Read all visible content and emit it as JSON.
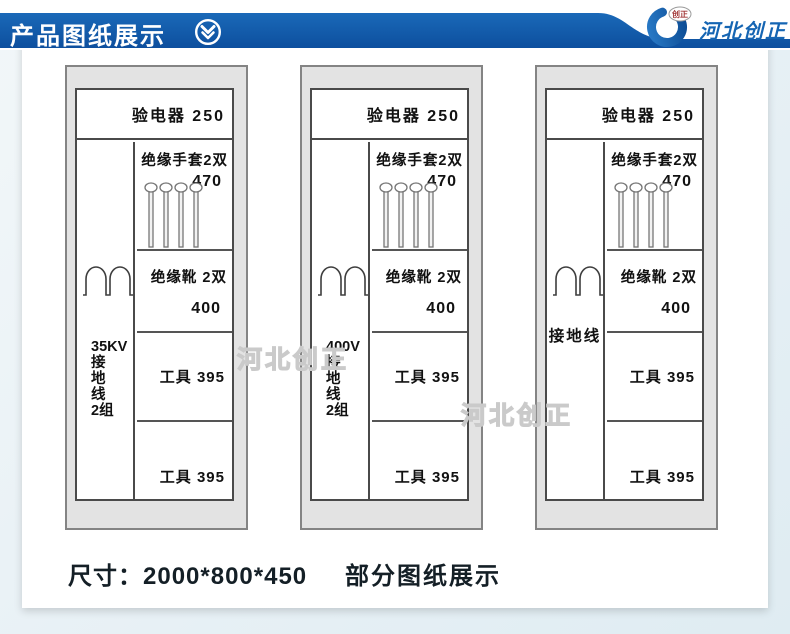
{
  "header": {
    "title": "产品图纸展示",
    "brand": {
      "badge_text": "创正",
      "name": "河北创正"
    },
    "colors": {
      "bar_blue": "#0e54a7",
      "bar_blue_light": "#1a69b8",
      "brand_blue": "#1565b3"
    }
  },
  "cabinets": [
    {
      "id": "cabinet-35kv",
      "left_column_lines": [
        "35KV",
        "接",
        "地",
        "线",
        "2组"
      ],
      "left_orientation": "vertical",
      "compartments": {
        "electroscope": "验电器 250",
        "gloves_label": "绝缘手套2双",
        "gloves_value": "470",
        "boots_label": "绝缘靴 2双",
        "boots_value": "400",
        "tools_upper": "工具 395",
        "tools_lower": "工具 395"
      }
    },
    {
      "id": "cabinet-400v",
      "left_column_lines": [
        "400V",
        "接",
        "地",
        "线",
        "2组"
      ],
      "left_orientation": "vertical",
      "compartments": {
        "electroscope": "验电器 250",
        "gloves_label": "绝缘手套2双",
        "gloves_value": "470",
        "boots_label": "绝缘靴 2双",
        "boots_value": "400",
        "tools_upper": "工具 395",
        "tools_lower": "工具 395"
      }
    },
    {
      "id": "cabinet-ground-wire",
      "left_column_lines": [
        "接地线"
      ],
      "left_orientation": "horizontal",
      "compartments": {
        "electroscope": "验电器 250",
        "gloves_label": "绝缘手套2双",
        "gloves_value": "470",
        "boots_label": "绝缘靴 2双",
        "boots_value": "400",
        "tools_upper": "工具 395",
        "tools_lower": "工具 395"
      }
    }
  ],
  "watermarks": [
    "河北创正",
    "河北创正"
  ],
  "footer": {
    "size_text": "尺寸：2000*800*450",
    "note_text": "部分图纸展示"
  }
}
